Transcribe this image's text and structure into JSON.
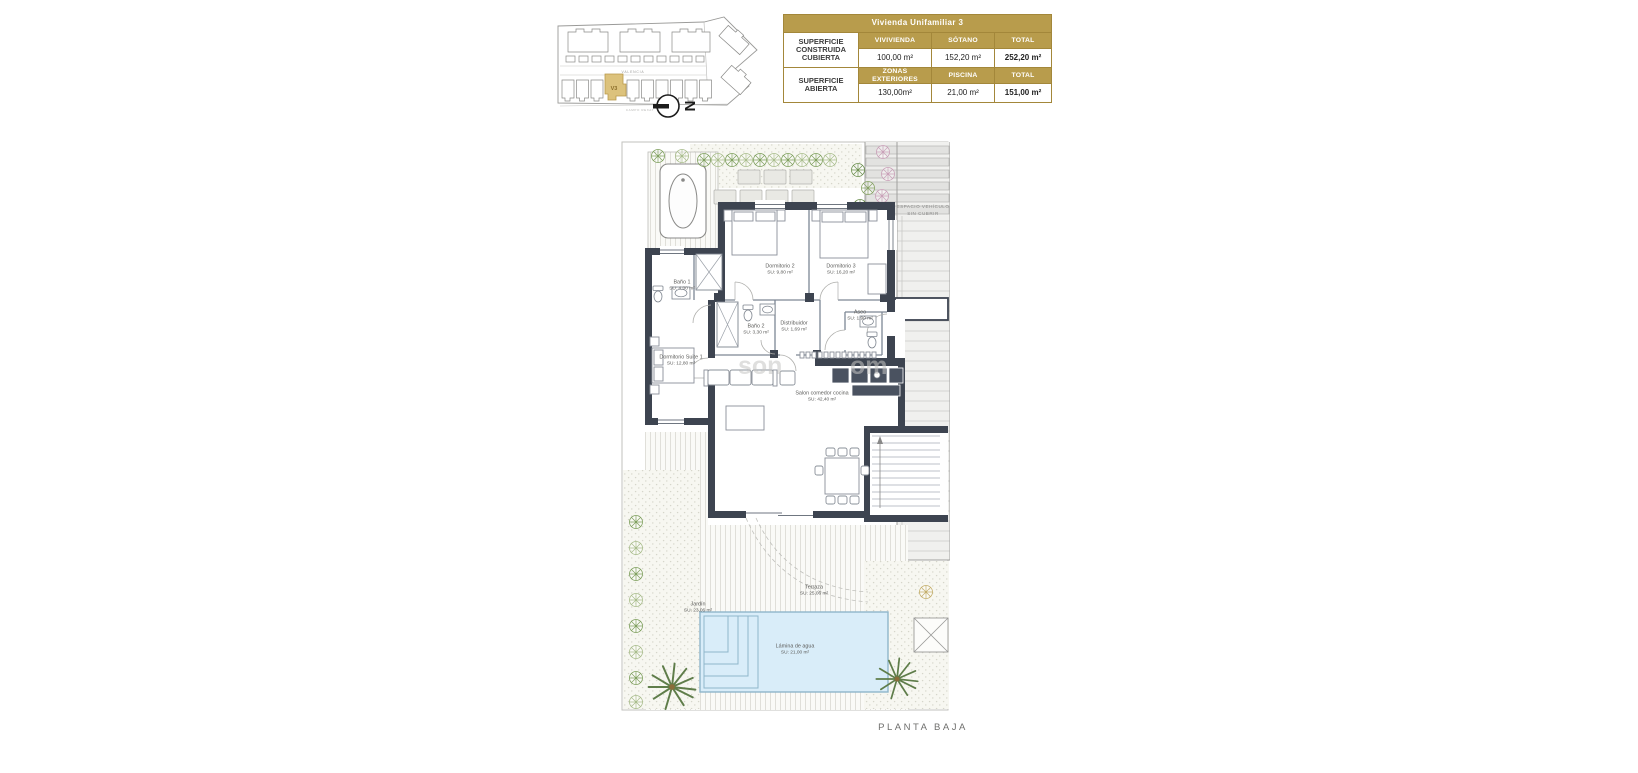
{
  "keyplan": {
    "street_top": "VALENCIA",
    "street_bottom": "CAMPO REXAT",
    "unit_label": "V3",
    "compass": "N"
  },
  "area_table": {
    "title": "Vivienda Unifamiliar 3",
    "groups": [
      {
        "label": "SUPERFICIE CONSTRUIDA CUBIERTA",
        "cols": [
          "VIVIVIENDA",
          "SÓTANO",
          "TOTAL"
        ],
        "vals": [
          "100,00 m²",
          "152,20 m²",
          "252,20 m²"
        ]
      },
      {
        "label": "SUPERFICIE ABIERTA",
        "cols": [
          "ZONAS EXTERIORES",
          "PISCINA",
          "TOTAL"
        ],
        "vals": [
          "130,00m²",
          "21,00 m²",
          "151,00 m²"
        ]
      }
    ]
  },
  "plan": {
    "rooms": [
      {
        "name": "Baño 1",
        "area": "SU: 4,00 m²"
      },
      {
        "name": "Dormitorio 2",
        "area": "SU: 9,80 m²"
      },
      {
        "name": "Dormitorio 3",
        "area": "SU: 16,20 m²"
      },
      {
        "name": "Baño 2",
        "area": "SU: 3,30 m²"
      },
      {
        "name": "Distribuidor",
        "area": "SU: 1,69 m²"
      },
      {
        "name": "Aseo",
        "area": "SU: 1,90 m²"
      },
      {
        "name": "Dormitorio Suite 1",
        "area": "SU: 12,80 m²"
      },
      {
        "name": "Salon comedor cocina",
        "area": "SU: 42,40 m²"
      },
      {
        "name": "Terraza",
        "area": "SU: 25,06 m²"
      },
      {
        "name": "Jardín",
        "area": "SU: 23,06 m²"
      },
      {
        "name": "Lámina de agua",
        "area": "SU: 21,00 m²"
      }
    ],
    "garage_line1": "ESPACIO VEHÍCULO",
    "garage_line2": "SIN CUBRIR",
    "watermark1": "son",
    "watermark2": "om",
    "footer": "PLANTA BAJA"
  },
  "colors": {
    "gold": "#b89c4c",
    "wall": "#3d4450",
    "pool": "#d9edf9"
  }
}
